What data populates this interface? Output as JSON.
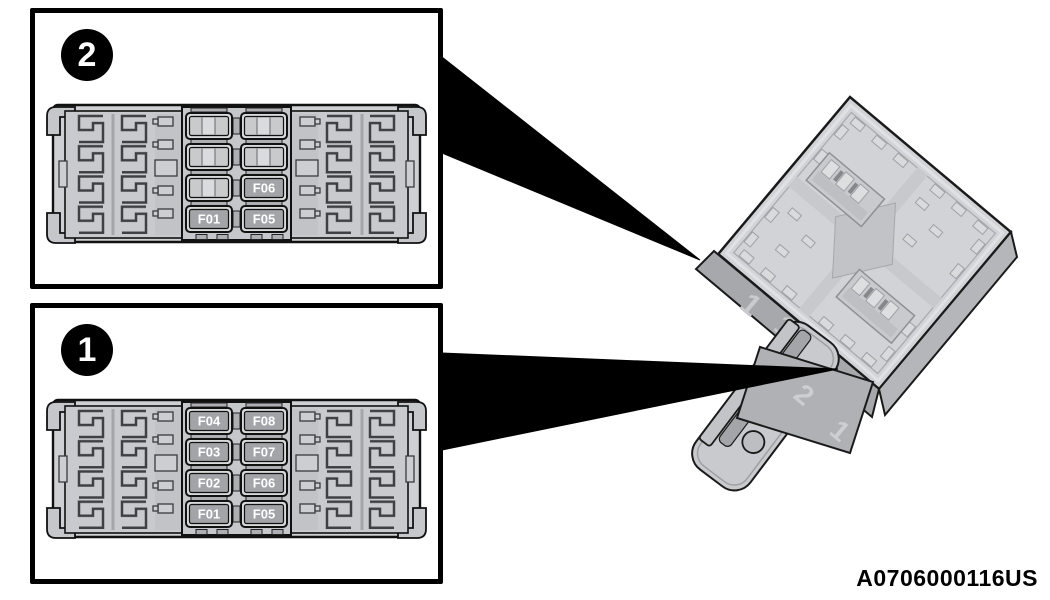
{
  "figure": {
    "part_code": "A0706000116US"
  },
  "callouts": [
    {
      "badge": "2",
      "fuses": {
        "r4c1": "F01",
        "r3c2": "F06",
        "r4c2": "F05"
      }
    },
    {
      "badge": "1",
      "fuses": {
        "r1c1": "F04",
        "r2c1": "F03",
        "r3c1": "F02",
        "r4c1": "F01",
        "r1c2": "F08",
        "r2c2": "F07",
        "r3c2": "F06",
        "r4c2": "F05"
      }
    }
  ],
  "module": {
    "molded_marks": {
      "side_face": [
        "1",
        "1"
      ],
      "bottom_face": [
        "2",
        "1"
      ]
    }
  },
  "colors": {
    "background": "#ffffff",
    "outline": "#1a1a1a",
    "plastic_light": "#d2d3d6",
    "plastic_mid": "#b0b1b5",
    "plastic_dark": "#a7a8ac",
    "fuse_fill": "#a2a4a8",
    "fuse_label_text": "#ffffff",
    "pointer": "#000000"
  }
}
